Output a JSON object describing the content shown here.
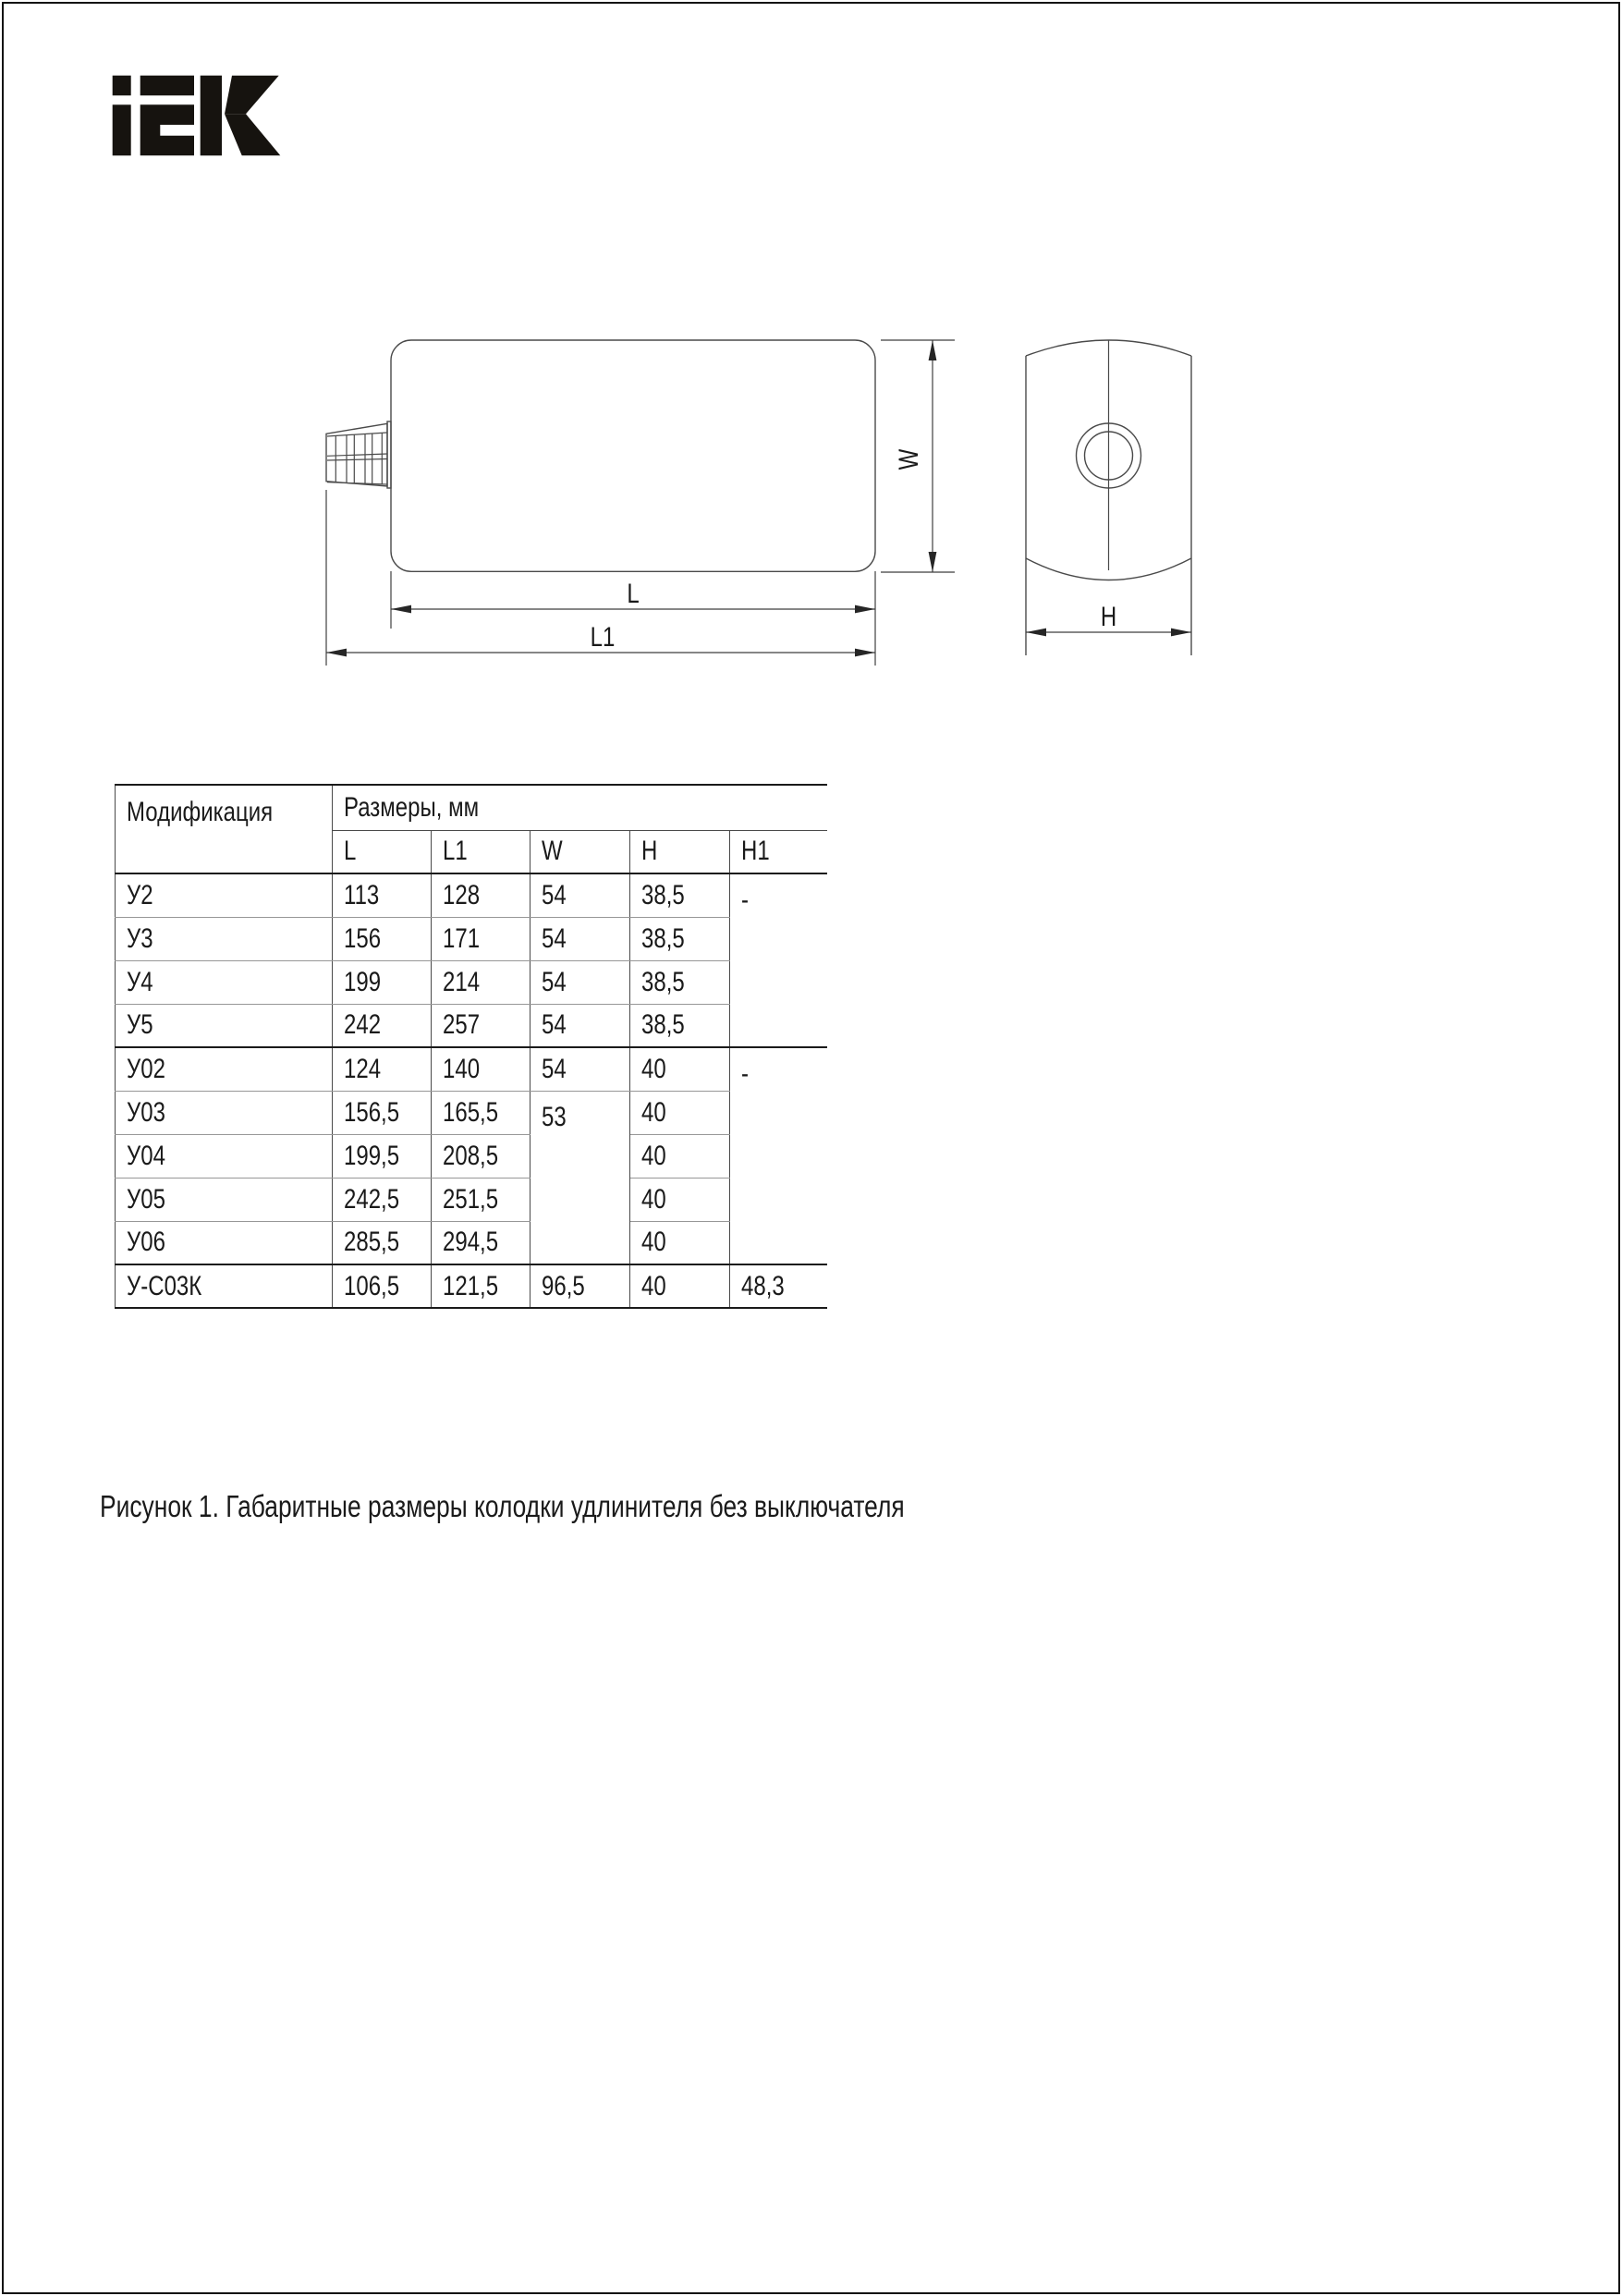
{
  "logo": {
    "text": "iEK",
    "color": "#16130f"
  },
  "drawing": {
    "labels": {
      "L": "L",
      "L1": "L1",
      "W": "W",
      "H": "H"
    }
  },
  "table": {
    "header": {
      "col1": "Модификация",
      "group": "Размеры, мм",
      "sub": [
        "L",
        "L1",
        "W",
        "H",
        "H1"
      ]
    },
    "rows": [
      {
        "cells": [
          {
            "t": "У2"
          },
          {
            "t": "113"
          },
          {
            "t": "128"
          },
          {
            "t": "54"
          },
          {
            "t": "38,5"
          },
          {
            "t": "-",
            "rs": 4,
            "tb": true,
            "last": true
          }
        ]
      },
      {
        "cells": [
          {
            "t": "У3"
          },
          {
            "t": "156"
          },
          {
            "t": "171"
          },
          {
            "t": "54"
          },
          {
            "t": "38,5"
          }
        ]
      },
      {
        "cells": [
          {
            "t": "У4"
          },
          {
            "t": "199"
          },
          {
            "t": "214"
          },
          {
            "t": "54"
          },
          {
            "t": "38,5"
          }
        ]
      },
      {
        "cells": [
          {
            "t": "У5"
          },
          {
            "t": "242"
          },
          {
            "t": "257"
          },
          {
            "t": "54"
          },
          {
            "t": "38,5"
          }
        ],
        "thick": true
      },
      {
        "cells": [
          {
            "t": "У02"
          },
          {
            "t": "124"
          },
          {
            "t": "140"
          },
          {
            "t": "54"
          },
          {
            "t": "40"
          },
          {
            "t": "-",
            "rs": 5,
            "tb": true,
            "last": true
          }
        ]
      },
      {
        "cells": [
          {
            "t": "У03"
          },
          {
            "t": "156,5"
          },
          {
            "t": "165,5"
          },
          {
            "t": "53",
            "rs": 4,
            "tb": true
          },
          {
            "t": "40"
          }
        ]
      },
      {
        "cells": [
          {
            "t": "У04"
          },
          {
            "t": "199,5"
          },
          {
            "t": "208,5"
          },
          {
            "t": "40"
          }
        ]
      },
      {
        "cells": [
          {
            "t": "У05"
          },
          {
            "t": "242,5"
          },
          {
            "t": "251,5"
          },
          {
            "t": "40"
          }
        ]
      },
      {
        "cells": [
          {
            "t": "У06"
          },
          {
            "t": "285,5"
          },
          {
            "t": "294,5"
          },
          {
            "t": "40"
          }
        ],
        "thick": true
      },
      {
        "cells": [
          {
            "t": "У-С03К"
          },
          {
            "t": "106,5"
          },
          {
            "t": "121,5"
          },
          {
            "t": "96,5"
          },
          {
            "t": "40"
          },
          {
            "t": "48,3",
            "last": true
          }
        ],
        "thick": true
      }
    ]
  },
  "caption": "Рисунок 1. Габаритные размеры колодки удлинителя без выключателя"
}
